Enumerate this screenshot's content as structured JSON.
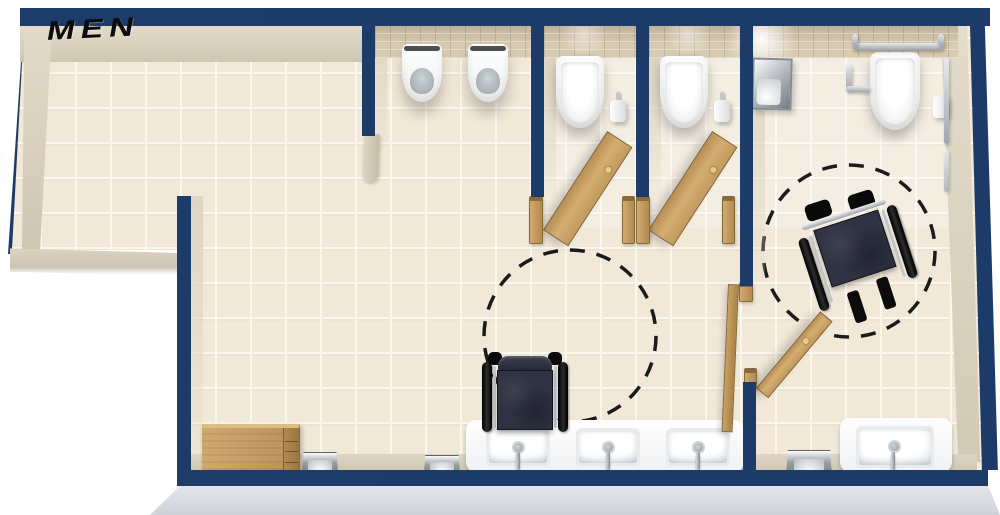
{
  "meta": {
    "type": "floor-plan",
    "view": "3d-top-down",
    "room": "men's restroom"
  },
  "labels": {
    "room_name": "MEN"
  },
  "palette": {
    "wall": "#1d3b68",
    "floor": "#f1e8d8",
    "grout": "#fbf7ee",
    "splash": "#d8cbb1",
    "wood": "#c9a164",
    "wood_dark": "#7d5f33",
    "counter": "#ffffff",
    "chrome": "#c3c8cd",
    "seat": "#2e3242",
    "skirt": "#d6d8de",
    "wall_face": "#ddd4c1",
    "ink": "#0c0c0c"
  },
  "inventory": [
    {
      "item": "urinal",
      "count": 2
    },
    {
      "item": "toilet",
      "count": 3
    },
    {
      "item": "sink-basin",
      "count": 4
    },
    {
      "item": "wheelchair",
      "count": 2
    },
    {
      "item": "turning-circle",
      "count": 2
    },
    {
      "item": "wood-door",
      "count": 3
    },
    {
      "item": "toilet-paper-holder",
      "count": 3
    },
    {
      "item": "grab-bar",
      "count": 4
    },
    {
      "item": "waste-bin",
      "count": 3
    },
    {
      "item": "cabinet",
      "count": 1
    },
    {
      "item": "towel-dispenser",
      "count": 1
    }
  ]
}
